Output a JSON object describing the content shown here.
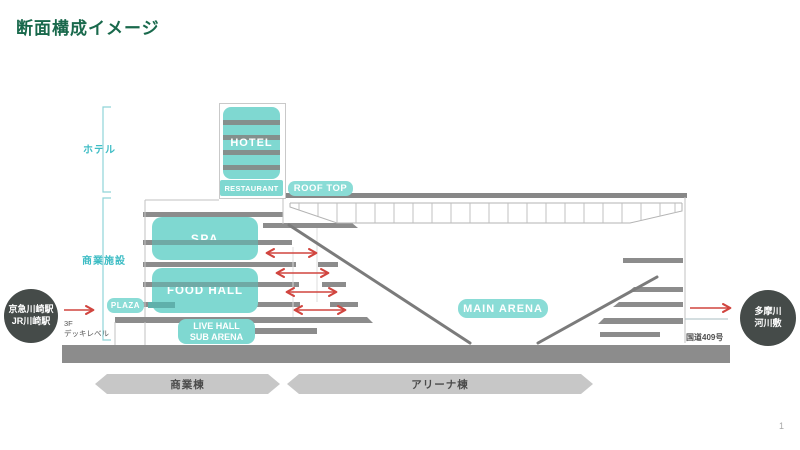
{
  "slide": {
    "title": "断面構成イメージ",
    "page_number": "1"
  },
  "section_labels": {
    "hotel": "ホテル",
    "commercial": "商業施設"
  },
  "facilities": {
    "hotel": "HOTEL",
    "restaurant": "RESTAURANT",
    "roof_top": "ROOF TOP",
    "spa": "SPA",
    "food_hall": "FOOD HALL",
    "plaza": "PLAZA",
    "live_hall_line1": "LIVE HALL",
    "live_hall_line2": "SUB ARENA",
    "main_arena": "MAIN ARENA"
  },
  "access": {
    "station_line1": "京急川崎駅",
    "station_line2": "JR川崎駅",
    "deck_line1": "3F",
    "deck_line2": "デッキレベル",
    "river_line1": "多摩川",
    "river_line2": "河川敷",
    "road": "国道409号"
  },
  "building_banners": {
    "commercial": "商業棟",
    "arena": "アリーナ棟"
  },
  "colors": {
    "title_green": "#19694c",
    "facility_teal": "#7fd8d1",
    "pill_teal": "#8adcd6",
    "floor_gray": "#8c8c8c",
    "banner_gray": "#c7c7c7",
    "station_circle_dark": "#454b49",
    "flow_arrow_red": "#d1453f",
    "bracket_teal": "#3fbdc5"
  }
}
